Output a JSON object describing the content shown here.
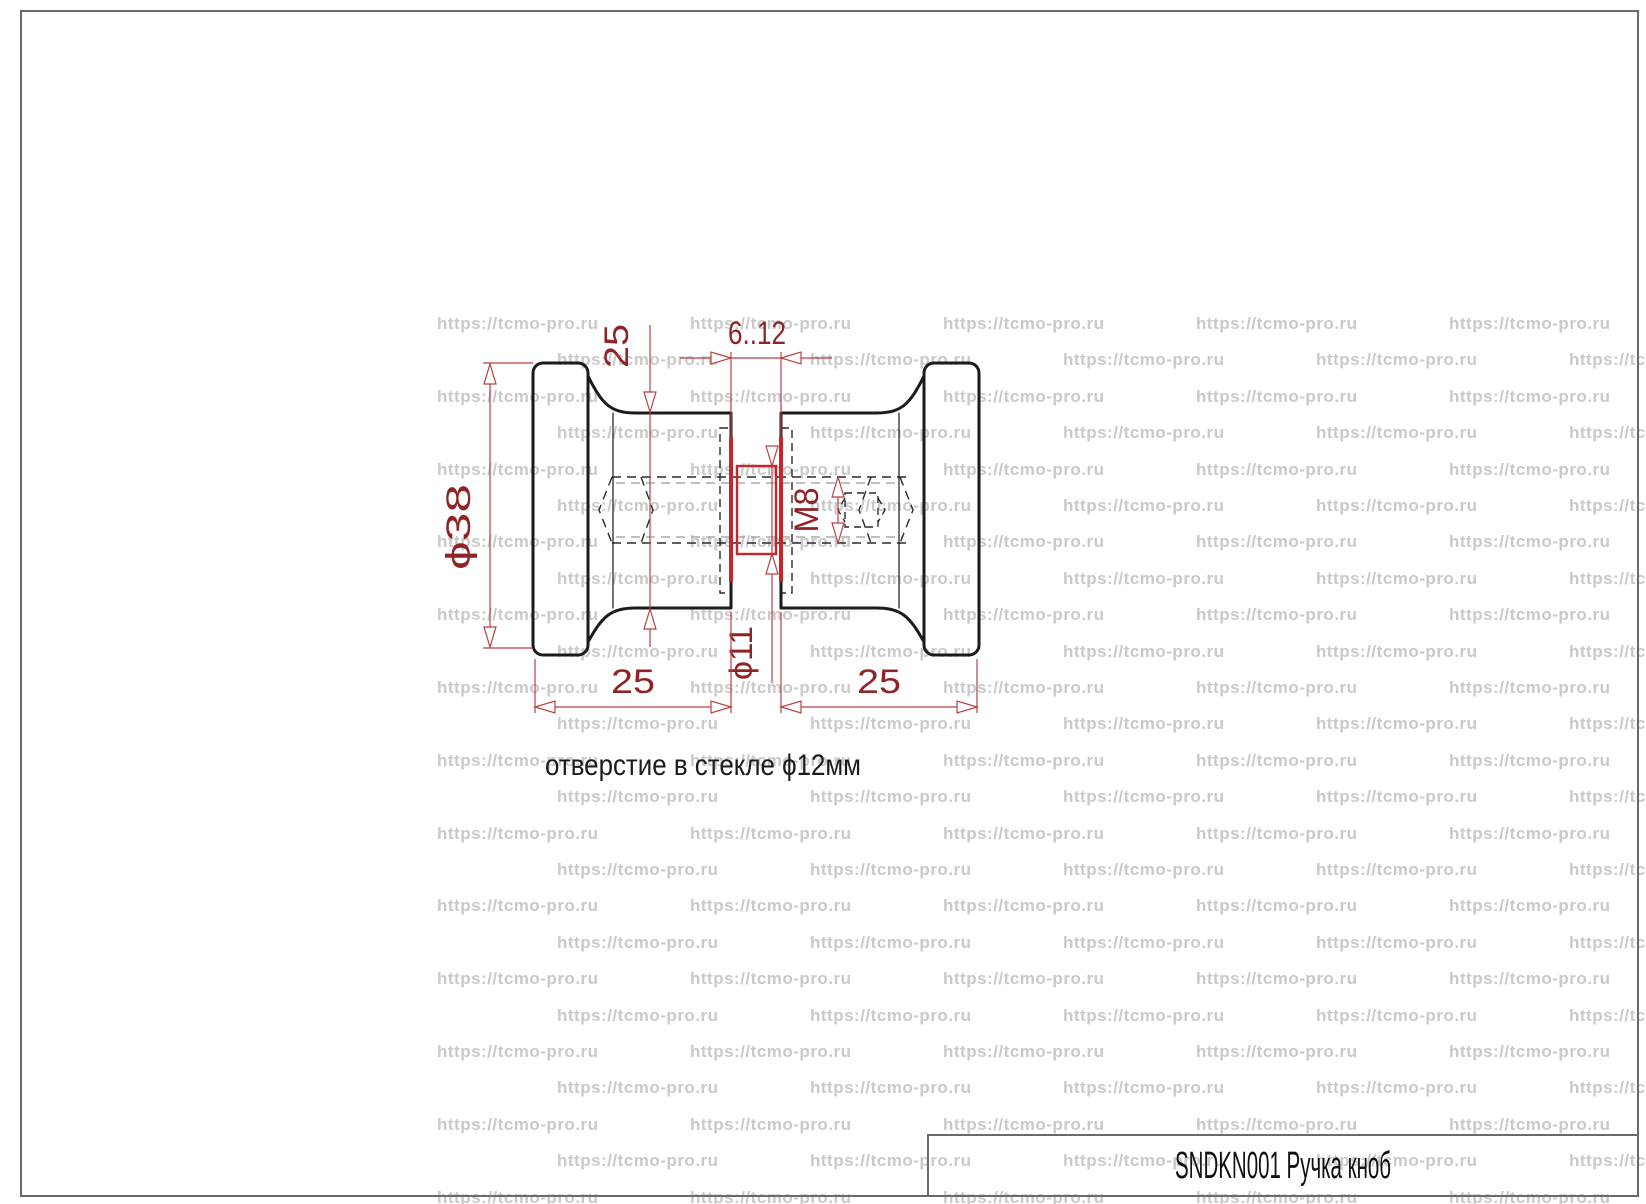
{
  "page": {
    "background": "#ffffff",
    "border_color": "#6a6a6a"
  },
  "watermark": {
    "text": "https://tcmo-pro.ru",
    "color": "#c9c9c9",
    "font_size": 17,
    "rows": {
      "start_y": 314,
      "step": 36.4,
      "count": 25
    },
    "columns": {
      "even_start_x": 437,
      "odd_start_x": 557,
      "step": 253,
      "max_x": 1610
    }
  },
  "title_block": {
    "label": "SNDKN001 Ручка кноб"
  },
  "drawing": {
    "note": "отверстие в стекле ϕ12мм",
    "dimensions": {
      "head_diameter": "ϕ38",
      "stem_diameter": "25",
      "glass_thickness": "6..12",
      "thread": "M8",
      "bushing_diameter": "ϕ11",
      "left_knob_length": "25",
      "right_knob_length": "25"
    },
    "colors": {
      "outline": "#1b1b1b",
      "hidden_line": "#2a2a2a",
      "thread_minor_line": "#9a9a9a",
      "dimension_line": "#b84040",
      "dimension_text": "#8f2328",
      "highlight_red": "#c5262c",
      "note_text": "#1b1b1b",
      "title_text": "#111111"
    }
  }
}
